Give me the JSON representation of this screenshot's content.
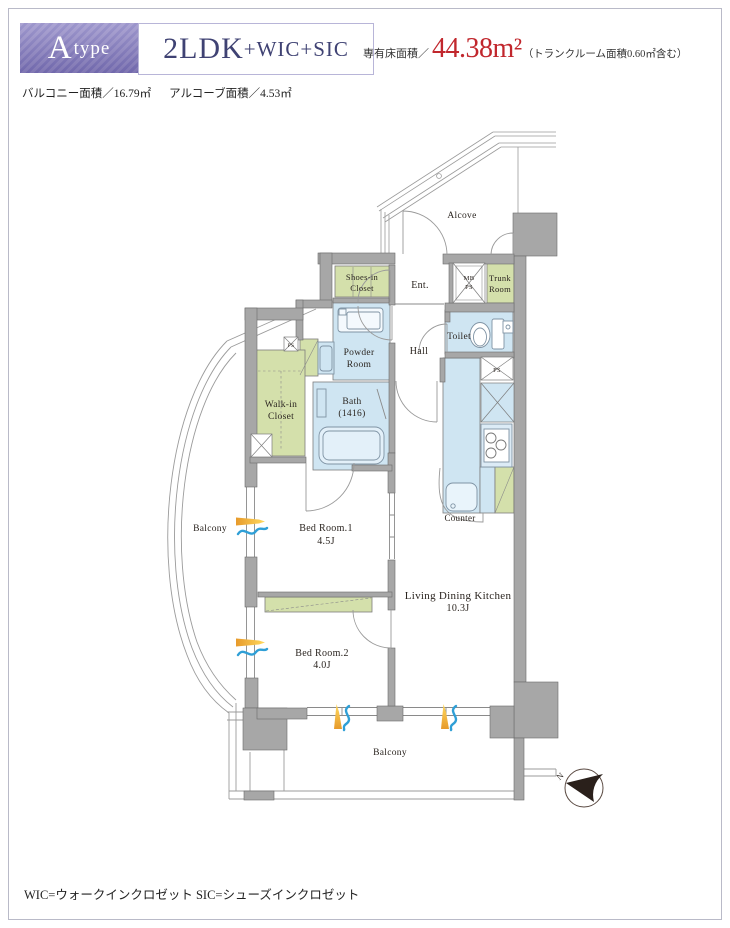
{
  "header": {
    "unit_type_letter": "A",
    "unit_type_word": "type",
    "layout_main": "2LDK",
    "layout_sub": "+WIC+SIC",
    "floor_area_label": "専有床面積／",
    "floor_area_value": "44.38m²",
    "floor_area_note": "（トランクルーム面積0.60㎡含む）",
    "balcony_area": "バルコニー面積／16.79㎡",
    "alcove_area": "アルコーブ面積／4.53㎡"
  },
  "plan": {
    "labels": {
      "alcove": "Alcove",
      "ent": "Ent.",
      "shoes1": "Shoes-in",
      "shoes2": "Closet",
      "mb": "MB",
      "mb_ps": "PS",
      "trunk1": "Trunk",
      "trunk2": "Room",
      "toilet": "Toilet",
      "powder1": "Powder",
      "powder2": "Room",
      "hall": "Hall",
      "wic1": "Walk-in",
      "wic2": "Closet",
      "bath1": "Bath",
      "bath2": "(1416)",
      "ps_upper": "PS",
      "ps_kitchen": "PS",
      "counter": "Counter",
      "ldk1": "Living Dining Kitchen",
      "ldk2": "10.3J",
      "bed1_name": "Bed Room.1",
      "bed1_size": "4.5J",
      "bed2_name": "Bed Room.2",
      "bed2_size": "4.0J",
      "balcony_left": "Balcony",
      "balcony_bottom": "Balcony",
      "north": "N"
    }
  },
  "footer": {
    "legend": "WIC=ウォークインクロゼット SIC=シューズインクロゼット"
  },
  "colors": {
    "accent_purple": "#857dc0",
    "layout_text": "#3f4273",
    "area_red": "#c1272d",
    "wall_gray": "#a7a7a7",
    "room_blue": "#cfe5f2",
    "room_green": "#d4e0ab",
    "marker_orange": "#f0a53c",
    "marker_blue": "#2f9fd6"
  }
}
